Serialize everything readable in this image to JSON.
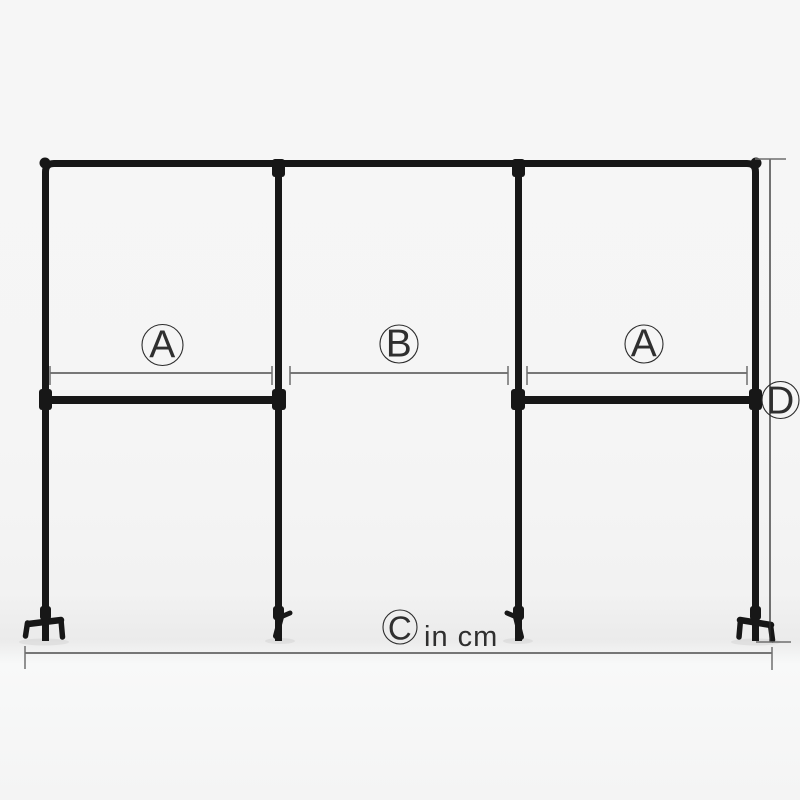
{
  "diagram": {
    "unit_note": "in cm",
    "labels": {
      "section_left": "A",
      "section_middle": "B",
      "section_right": "A",
      "total_width": "C",
      "overall_height": "D"
    },
    "colors": {
      "pipe": "#171717",
      "dimension": "#2c2c2c",
      "tick": "#6f6f6f",
      "text": "#2f2f2f"
    }
  }
}
